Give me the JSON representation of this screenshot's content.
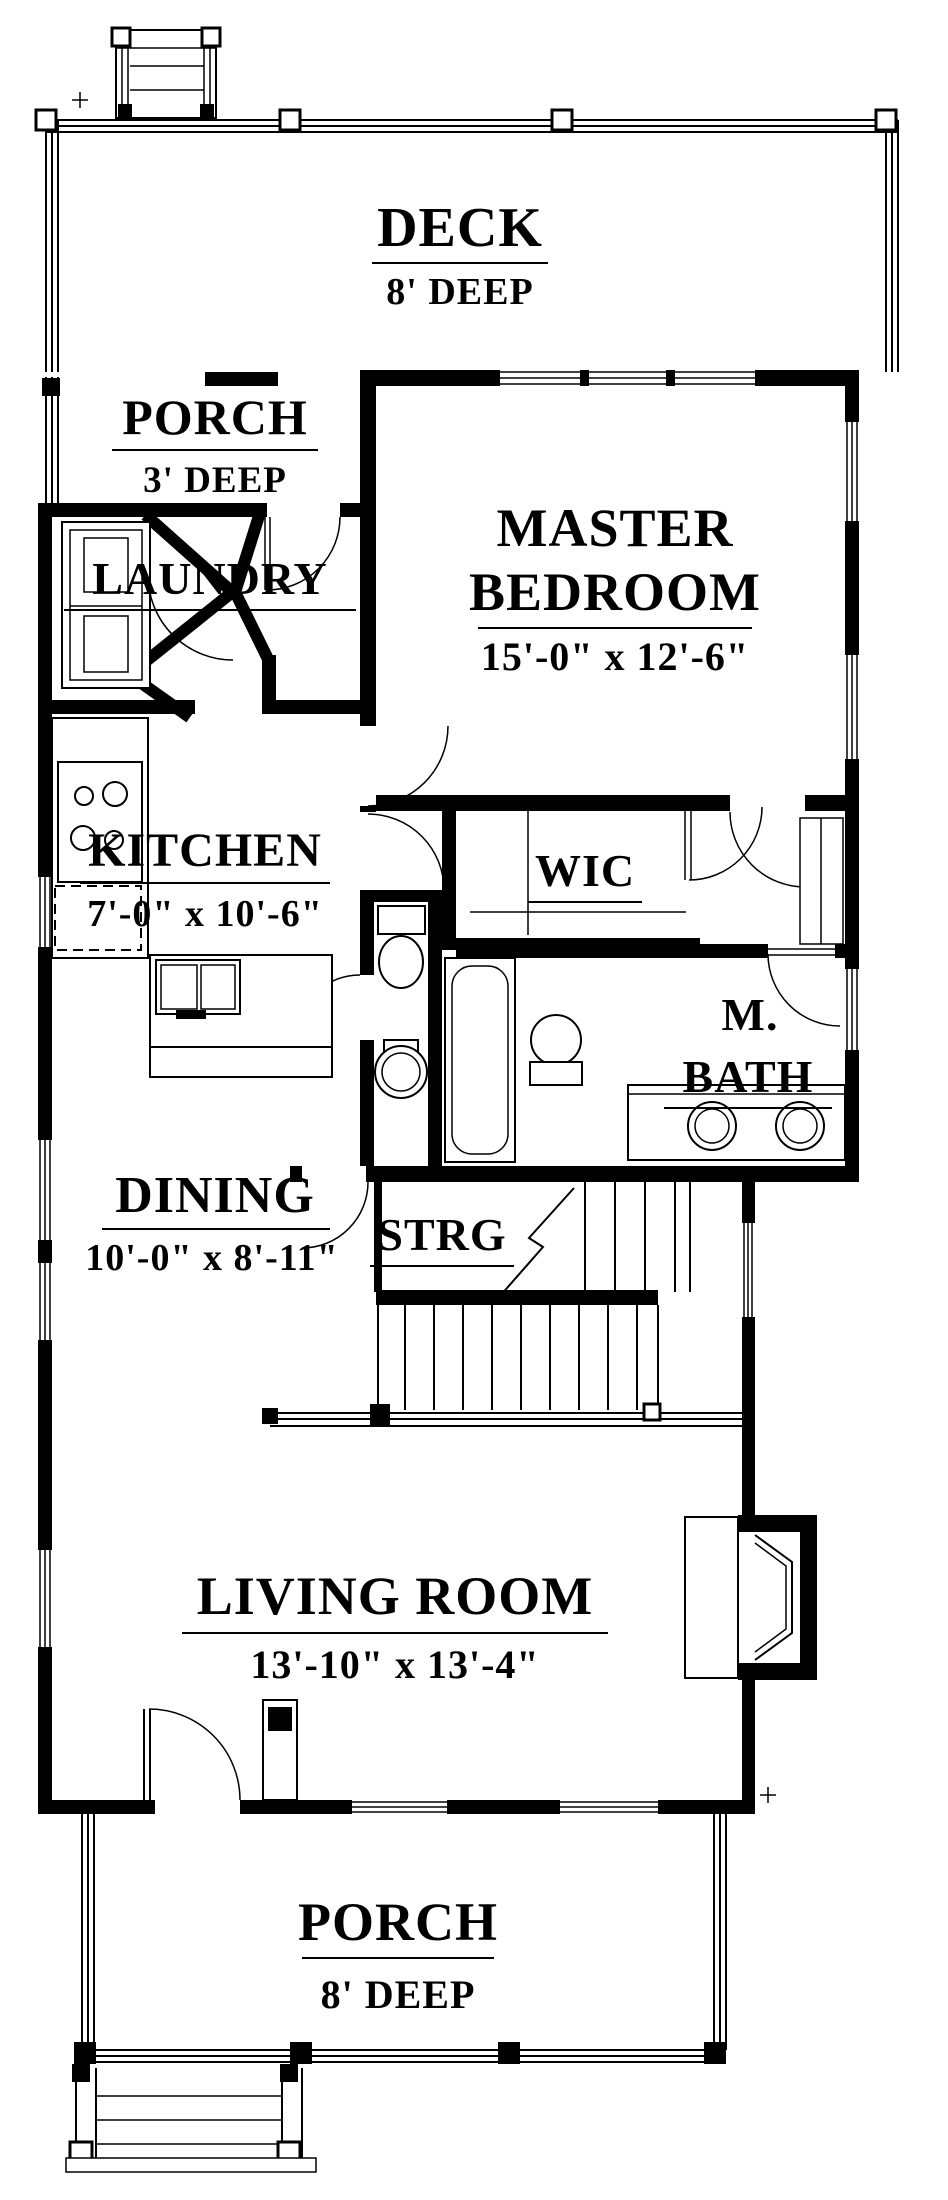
{
  "title": "First Floor Plan",
  "colors": {
    "ink": "#000000",
    "paper": "#ffffff"
  },
  "rooms": {
    "deck": {
      "name": "DECK",
      "dim": "8' DEEP"
    },
    "porch_top": {
      "name": "PORCH",
      "dim": "3' DEEP"
    },
    "master": {
      "line1": "MASTER",
      "line2": "BEDROOM",
      "dim": "15'-0\" x 12'-6\""
    },
    "laundry": {
      "name": "LAUNDRY"
    },
    "kitchen": {
      "name": "KITCHEN",
      "dim": "7'-0\" x 10'-6\""
    },
    "wic": {
      "name": "WIC"
    },
    "mbath": {
      "line1": "M.",
      "line2": "BATH"
    },
    "dining": {
      "name": "DINING",
      "dim": "10'-0\" x 8'-11\""
    },
    "strg": {
      "name": "STRG"
    },
    "living": {
      "name": "LIVING ROOM",
      "dim": "13'-10\" x 13'-4\""
    },
    "porch_bottom": {
      "name": "PORCH",
      "dim": "8' DEEP"
    }
  }
}
